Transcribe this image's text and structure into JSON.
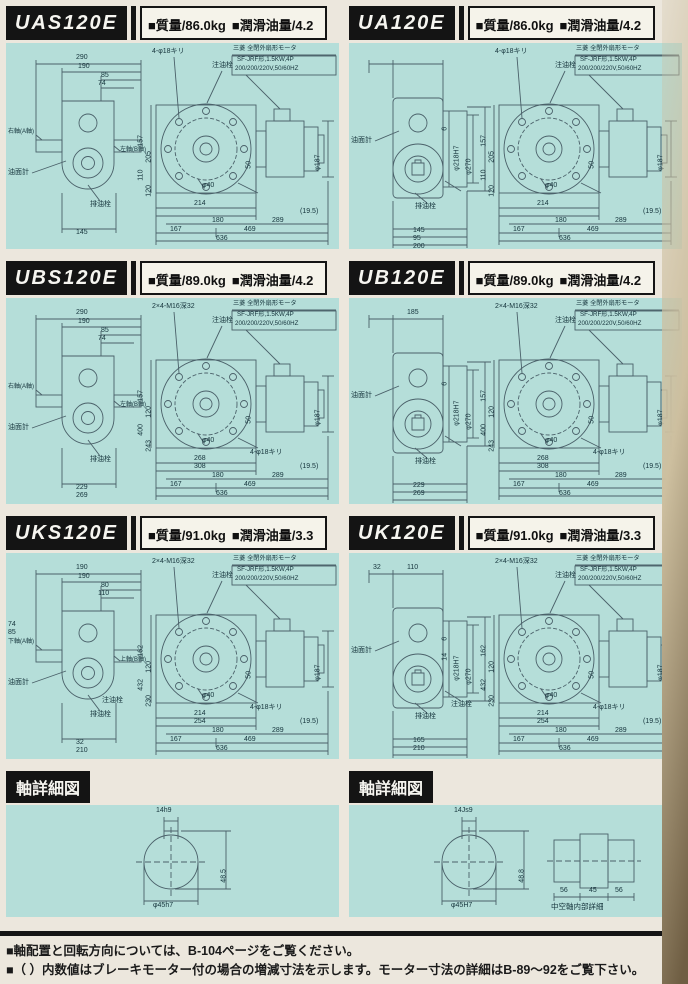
{
  "colors": {
    "panel_bg": "#b5ded9",
    "ink": "#141414",
    "line": "#4a6069",
    "paper": "#ece7dd",
    "spec_bg": "#f5f3ea",
    "edge_light": "#cdbf9f",
    "edge_dark": "#6f5e43"
  },
  "panels": [
    {
      "model": "UAS120E",
      "mass": "■質量/86.0kg",
      "oil": "■潤滑油量/4.2",
      "top_dims": [
        "290",
        "190",
        "85",
        "74"
      ],
      "shaft_a": "右軸(A軸)",
      "gauge": "油面計",
      "drain": "排油栓",
      "shaft_b": "左軸(B軸)",
      "side": [
        null,
        null
      ],
      "filler_left": null,
      "left_bottom": [
        "145",
        null
      ],
      "holes_top": "4-φ18キリ",
      "holes_bottom": null,
      "filler": "注油栓",
      "motor": [
        "三菱 全閉外扇形モータ",
        "SF-JRF形,1.5KW,4P",
        "200/200/220V,50/60HZ"
      ],
      "vert": [
        "157",
        "110",
        "205",
        "120"
      ],
      "mid": [
        "214",
        null,
        "180",
        "289"
      ],
      "bottom": [
        "167",
        "469",
        "636"
      ],
      "paren": "(19.5)",
      "plug": "φ40",
      "dim50": "50",
      "motor_dia": "φ187"
    },
    {
      "model": "UA120E",
      "mass": "■質量/86.0kg",
      "oil": "■潤滑油量/4.2",
      "top": [
        null,
        null
      ],
      "gauge": "油面計",
      "drain": "排油栓",
      "filler2": null,
      "flange": [
        "6",
        null,
        "φ218H7",
        "φ270"
      ],
      "left_bottom": [
        "145",
        "95",
        "200"
      ],
      "holes_top": "4-φ18キリ",
      "holes_bottom": null,
      "filler": "注油栓",
      "motor": [
        "三菱 全閉外扇形モータ",
        "SF-JRF形,1.5KW,4P",
        "200/200/220V,50/60HZ"
      ],
      "vert": [
        "157",
        "110",
        "205",
        "120"
      ],
      "mid": [
        "214",
        null,
        "180",
        "289"
      ],
      "bottom": [
        "167",
        "469",
        "636"
      ],
      "paren": "(19.5)",
      "plug": "φ40",
      "dim50": "50",
      "motor_dia": "φ187"
    },
    {
      "model": "UBS120E",
      "mass": "■質量/89.0kg",
      "oil": "■潤滑油量/4.2",
      "top_dims": [
        "290",
        "190",
        "85",
        "74"
      ],
      "shaft_a": "右軸(A軸)",
      "gauge": "油面計",
      "drain": "排油栓",
      "shaft_b": "左軸(B軸)",
      "side": [
        null,
        null
      ],
      "filler_left": null,
      "left_bottom": [
        "229",
        "269"
      ],
      "holes_top": "2×4-M16深32",
      "holes_bottom": "4-φ18キリ",
      "filler": "注油栓",
      "motor": [
        "三菱 全閉外扇形モータ",
        "SF-JRF形,1.5KW,4P",
        "200/200/220V,50/60HZ"
      ],
      "vert": [
        "157",
        "400",
        "120",
        "243"
      ],
      "mid": [
        "268",
        "308",
        "180",
        "289"
      ],
      "bottom": [
        "167",
        "469",
        "636"
      ],
      "paren": "(19.5)",
      "plug": "φ40",
      "dim50": "50",
      "motor_dia": "φ187"
    },
    {
      "model": "UB120E",
      "mass": "■質量/89.0kg",
      "oil": "■潤滑油量/4.2",
      "top": [
        "185",
        null
      ],
      "gauge": "油面計",
      "drain": "排油栓",
      "filler2": null,
      "flange": [
        "6",
        null,
        "φ218H7",
        "φ270"
      ],
      "left_bottom": [
        "229",
        "269",
        null
      ],
      "holes_top": "2×4-M16深32",
      "holes_bottom": "4-φ18キリ",
      "filler": "注油栓",
      "motor": [
        "三菱 全閉外扇形モータ",
        "SF-JRF形,1.5KW,4P",
        "200/200/220V,50/60HZ"
      ],
      "vert": [
        "157",
        "400",
        "120",
        "243"
      ],
      "mid": [
        "268",
        "308",
        "180",
        "289"
      ],
      "bottom": [
        "167",
        "469",
        "636"
      ],
      "paren": "(19.5)",
      "plug": "φ40",
      "dim50": "50",
      "motor_dia": "φ187"
    },
    {
      "model": "UKS120E",
      "mass": "■質量/91.0kg",
      "oil": "■潤滑油量/3.3",
      "top_dims": [
        "190",
        "190",
        "80",
        "110"
      ],
      "shaft_a": "下軸(A軸)",
      "gauge": "油面計",
      "drain": "排油栓",
      "shaft_b": "上軸(B軸)",
      "side": [
        "74",
        "85"
      ],
      "filler_left": "注油栓",
      "left_bottom": [
        "32",
        "210"
      ],
      "holes_top": "2×4-M16深32",
      "holes_bottom": "4-φ18キリ",
      "filler": "注油栓",
      "motor": [
        "三菱 全閉外扇形モータ",
        "SF-JRF形,1.5KW,4P",
        "200/200/220V,50/60HZ"
      ],
      "vert": [
        "162",
        "432",
        "120",
        "230"
      ],
      "mid": [
        "214",
        "254",
        "180",
        "289"
      ],
      "bottom": [
        "167",
        "469",
        "636"
      ],
      "paren": "(19.5)",
      "plug": "φ40",
      "dim50": "50",
      "motor_dia": "φ187"
    },
    {
      "model": "UK120E",
      "mass": "■質量/91.0kg",
      "oil": "■潤滑油量/3.3",
      "top": [
        "110",
        "32"
      ],
      "gauge": "油面計",
      "drain": "排油栓",
      "filler2": "注油栓",
      "flange": [
        "6",
        "14",
        "φ218H7",
        "φ270"
      ],
      "left_bottom": [
        "165",
        "210",
        null
      ],
      "holes_top": "2×4-M16深32",
      "holes_bottom": "4-φ18キリ",
      "filler": "注油栓",
      "motor": [
        "三菱 全閉外扇形モータ",
        "SF-JRF形,1.5KW,4P",
        "200/200/220V,50/60HZ"
      ],
      "vert": [
        "162",
        "432",
        "120",
        "230"
      ],
      "mid": [
        "214",
        "254",
        "180",
        "289"
      ],
      "bottom": [
        "167",
        "469",
        "636"
      ],
      "paren": "(19.5)",
      "plug": "φ40",
      "dim50": "50",
      "motor_dia": "φ187"
    }
  ],
  "shaft_left": {
    "title": "軸詳細図",
    "key": "14h9",
    "height": "48.5",
    "dia": "φ45h7"
  },
  "shaft_right": {
    "title": "軸詳細図",
    "key": "14Js9",
    "height": "48.8",
    "dia": "φ45H7",
    "hollow": [
      "56",
      "45",
      "56"
    ],
    "caption": "中空軸内部詳細"
  },
  "footer": {
    "note1": "■軸配置と回転方向については、B-104ページをご覧ください。",
    "note2": "■（ ）内数値はブレーキモーター付の場合の増減寸法を示します。モーター寸法の詳細はB-89～92をご覧下さい。"
  }
}
